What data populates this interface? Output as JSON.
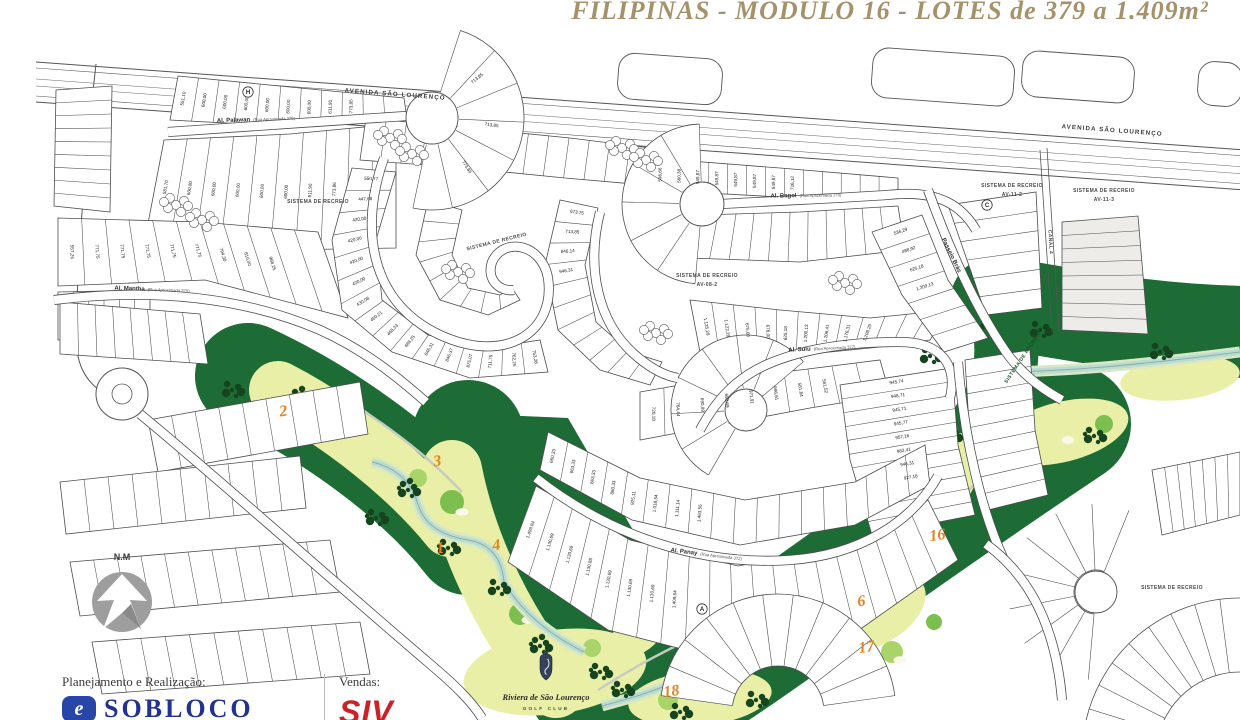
{
  "title": "FILIPINAS - MODULO 16 - LOTES de 379 a 1.409m²",
  "compass": {
    "label": "N.M"
  },
  "footer": {
    "planning_label": "Planejamento e Realização:",
    "planning_brand": "SOBLOCO",
    "sales_label": "Vendas:",
    "sales_brand": "SIV"
  },
  "colors": {
    "title_gold": "#a5916a",
    "golf_dark_green": "#1d6b35",
    "fairway_green": "#e9efa6",
    "green_circle": "#7cbf4f",
    "stream_teal": "#b7ddd3",
    "hole_number_orange": "#e8821c",
    "sobloco_navy": "#21338f",
    "siv_red": "#cd2027"
  },
  "map": {
    "avenue": "AVENIDA SÃO LOURENÇO",
    "canal": "CANAL 4",
    "recreation_label": "SISTEMA DE RECREIO",
    "recreation_codes": [
      "AV-08-2",
      "AV-11-2",
      "AV-11-3"
    ],
    "streets": [
      {
        "name": "Al. Palawan",
        "detail": "(Rua Aproximada 376)"
      },
      {
        "name": "Al. Mantha",
        "detail": "(Rua Aproximada 375)"
      },
      {
        "name": "Al. Bagol",
        "detail": "(Rua Aproximada 370)"
      },
      {
        "name": "Al. Sulu",
        "detail": "(Rua Aproximada 377)"
      },
      {
        "name": "Al. Panay",
        "detail": "(Rua Aproximada 372)"
      },
      {
        "name": "Passeio Brás",
        "detail": ""
      }
    ],
    "golf_club": {
      "name": "Riviera de São Lourenço",
      "subtitle": "GOLF CLUB"
    },
    "golf_holes": [
      "2",
      "3",
      "1",
      "4",
      "18",
      "17",
      "6",
      "16"
    ],
    "block_markers": [
      "H",
      "C",
      "A"
    ],
    "lot_areas": {
      "palawan_top": [
        "551,10",
        "600,00",
        "600,00",
        "600,00",
        "600,00",
        "600,00",
        "600,00",
        "611,90",
        "773,85"
      ],
      "palawan_bottom": [
        "581,70",
        "600,00",
        "600,00",
        "600,00",
        "600,00",
        "600,00",
        "611,90",
        "773,86"
      ],
      "palawan_cap": [
        "713,85",
        "713,85",
        "773,86"
      ],
      "mantha": [
        "557,26",
        "771,75",
        "771,75",
        "771,75",
        "771,75",
        "771,75",
        "794,30",
        "810,00",
        "968,25"
      ],
      "spiral": [
        "550,77",
        "447,68",
        "420,00",
        "420,00",
        "420,00",
        "420,00",
        "430,08",
        "460,21",
        "465,33",
        "488,25",
        "846,31",
        "846,37",
        "875,07",
        "711,75",
        "762,25",
        "753,28"
      ],
      "center_hook": [
        "673,75",
        "713,85",
        "846,14",
        "946,31"
      ],
      "bagol": [
        "596,66",
        "560,38",
        "549,87",
        "549,87",
        "549,87",
        "549,87",
        "549,87",
        "726,12"
      ],
      "below_bagol": [
        "1.135,29",
        "1.122,29",
        "675,00",
        "678,00",
        "625,18",
        "1.200,13",
        "1.206,41",
        "1.176,31",
        "1.208,29"
      ],
      "sulu": [
        "720,18",
        "764,44",
        "690,99",
        "690,69",
        "971,91",
        "696,61",
        "581,84",
        "561,52"
      ],
      "panay_upper": [
        "660,33",
        "663,33",
        "863,33",
        "860,33",
        "925,11",
        "1.018,54",
        "1.111,14",
        "1.463,56"
      ],
      "panay_lower": [
        "1.409,84",
        "1.130,69",
        "1.130,69",
        "1.130,88",
        "1.130,69",
        "1.130,69",
        "1.130,69",
        "1.409,64"
      ],
      "east": [
        "945,74",
        "948,71",
        "945,71",
        "945,77",
        "957,16",
        "982,41",
        "946,31",
        "927,18"
      ],
      "passeio": [
        "536,29",
        "488,92",
        "625,18",
        "1.209,13"
      ]
    }
  }
}
